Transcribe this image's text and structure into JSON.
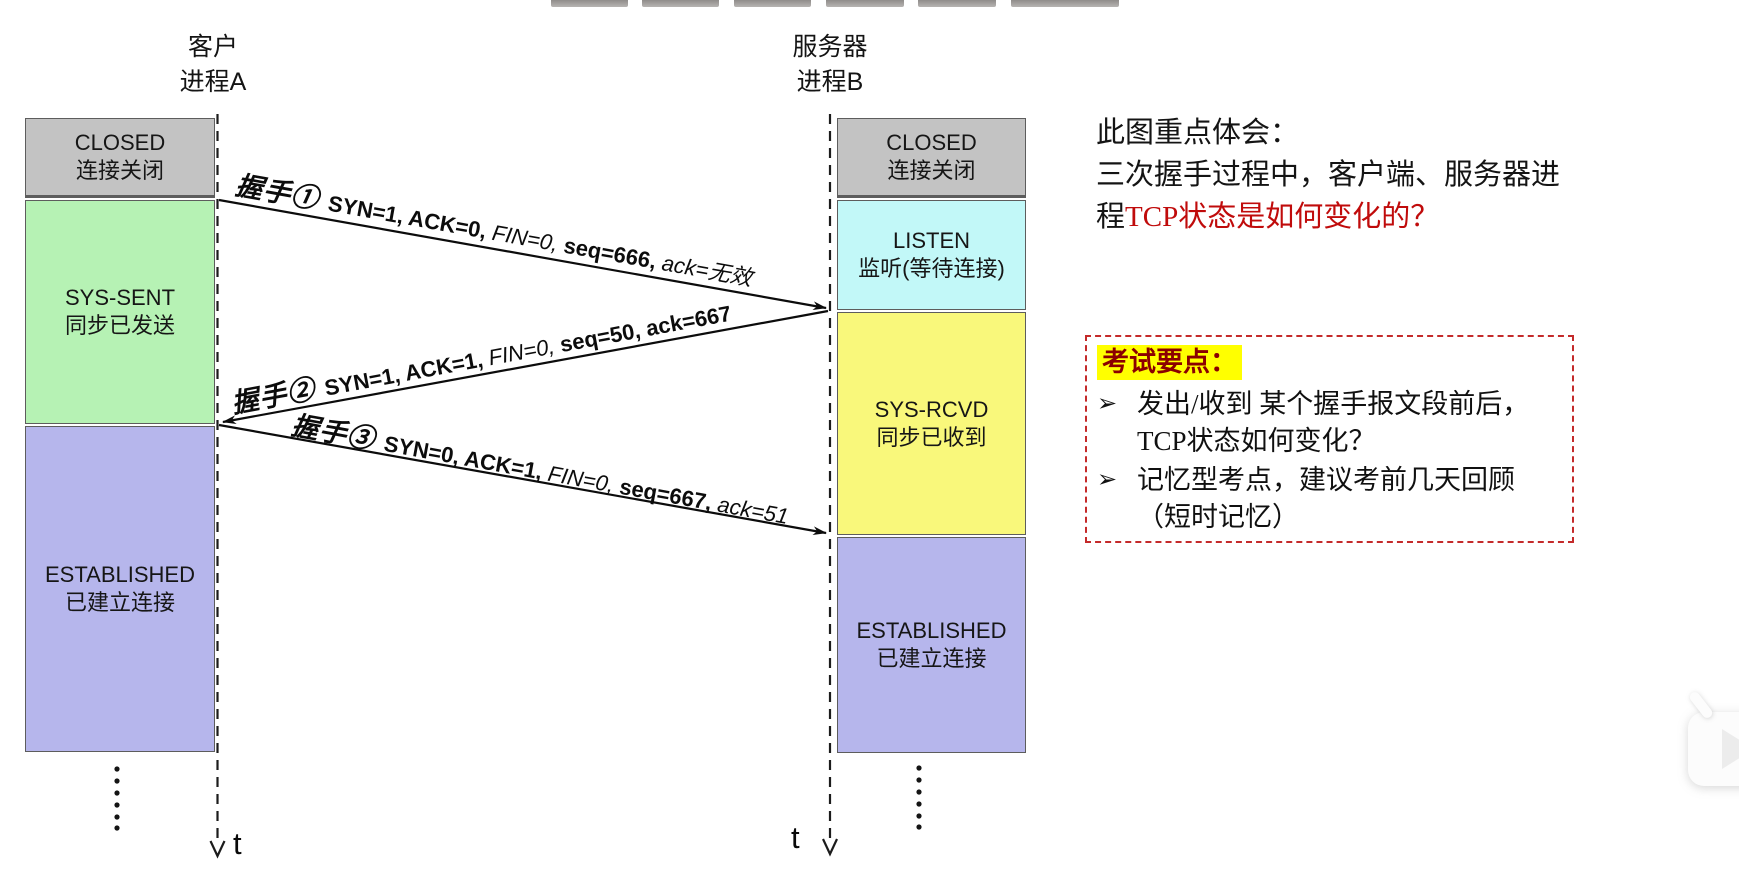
{
  "client": {
    "title_line1": "客户",
    "title_line2": "进程A",
    "timeline_label": "t",
    "states": [
      {
        "name": "CLOSED",
        "desc": "连接关闭",
        "color": "#c3c3c3"
      },
      {
        "name": "SYS-SENT",
        "desc": "同步已发送",
        "color": "#b6f2b4"
      },
      {
        "name": "ESTABLISHED",
        "desc": "已建立连接",
        "color": "#b6b6ec"
      }
    ]
  },
  "server": {
    "title_line1": "服务器",
    "title_line2": "进程B",
    "timeline_label": "t",
    "states": [
      {
        "name": "CLOSED",
        "desc": "连接关闭",
        "color": "#c3c3c3"
      },
      {
        "name": "LISTEN",
        "desc": "监听(等待连接)",
        "color": "#c2f8f8"
      },
      {
        "name": "SYS-RCVD",
        "desc": "同步已收到",
        "color": "#f9f87b"
      },
      {
        "name": "ESTABLISHED",
        "desc": "已建立连接",
        "color": "#b6b6ec"
      }
    ]
  },
  "arrows": [
    {
      "hand": "握手①",
      "p1": "SYN=1, ACK=0, ",
      "p2": "FIN=0, ",
      "p3": "seq=666, ",
      "p4": "ack=无效"
    },
    {
      "hand": "握手②",
      "p1": "SYN=1, ACK=1, ",
      "p2": "FIN=0, ",
      "p3": "seq=50, ack=667",
      "p4": ""
    },
    {
      "hand": "握手③",
      "p1": "SYN=0, ACK=1, ",
      "p2": "FIN=0, ",
      "p3": "seq=667, ",
      "p4": "ack=51"
    }
  ],
  "note": {
    "line1": "此图重点体会：",
    "line2": "三次握手过程中，客户端、服务器进",
    "line3_black": "程",
    "line3_red": "TCP状态是如何变化的？",
    "red_color": "#c00b0b"
  },
  "exam_box": {
    "title": "考试要点：",
    "title_color": "#8b0000",
    "highlight_color": "#ffff00",
    "border_color": "#c42a2a",
    "bullet_glyph": "➢",
    "bullets": [
      "发出/收到 某个握手报文段前后，TCP状态如何变化？",
      "记忆型考点，建议考前几天回顾（短时记忆）"
    ]
  }
}
